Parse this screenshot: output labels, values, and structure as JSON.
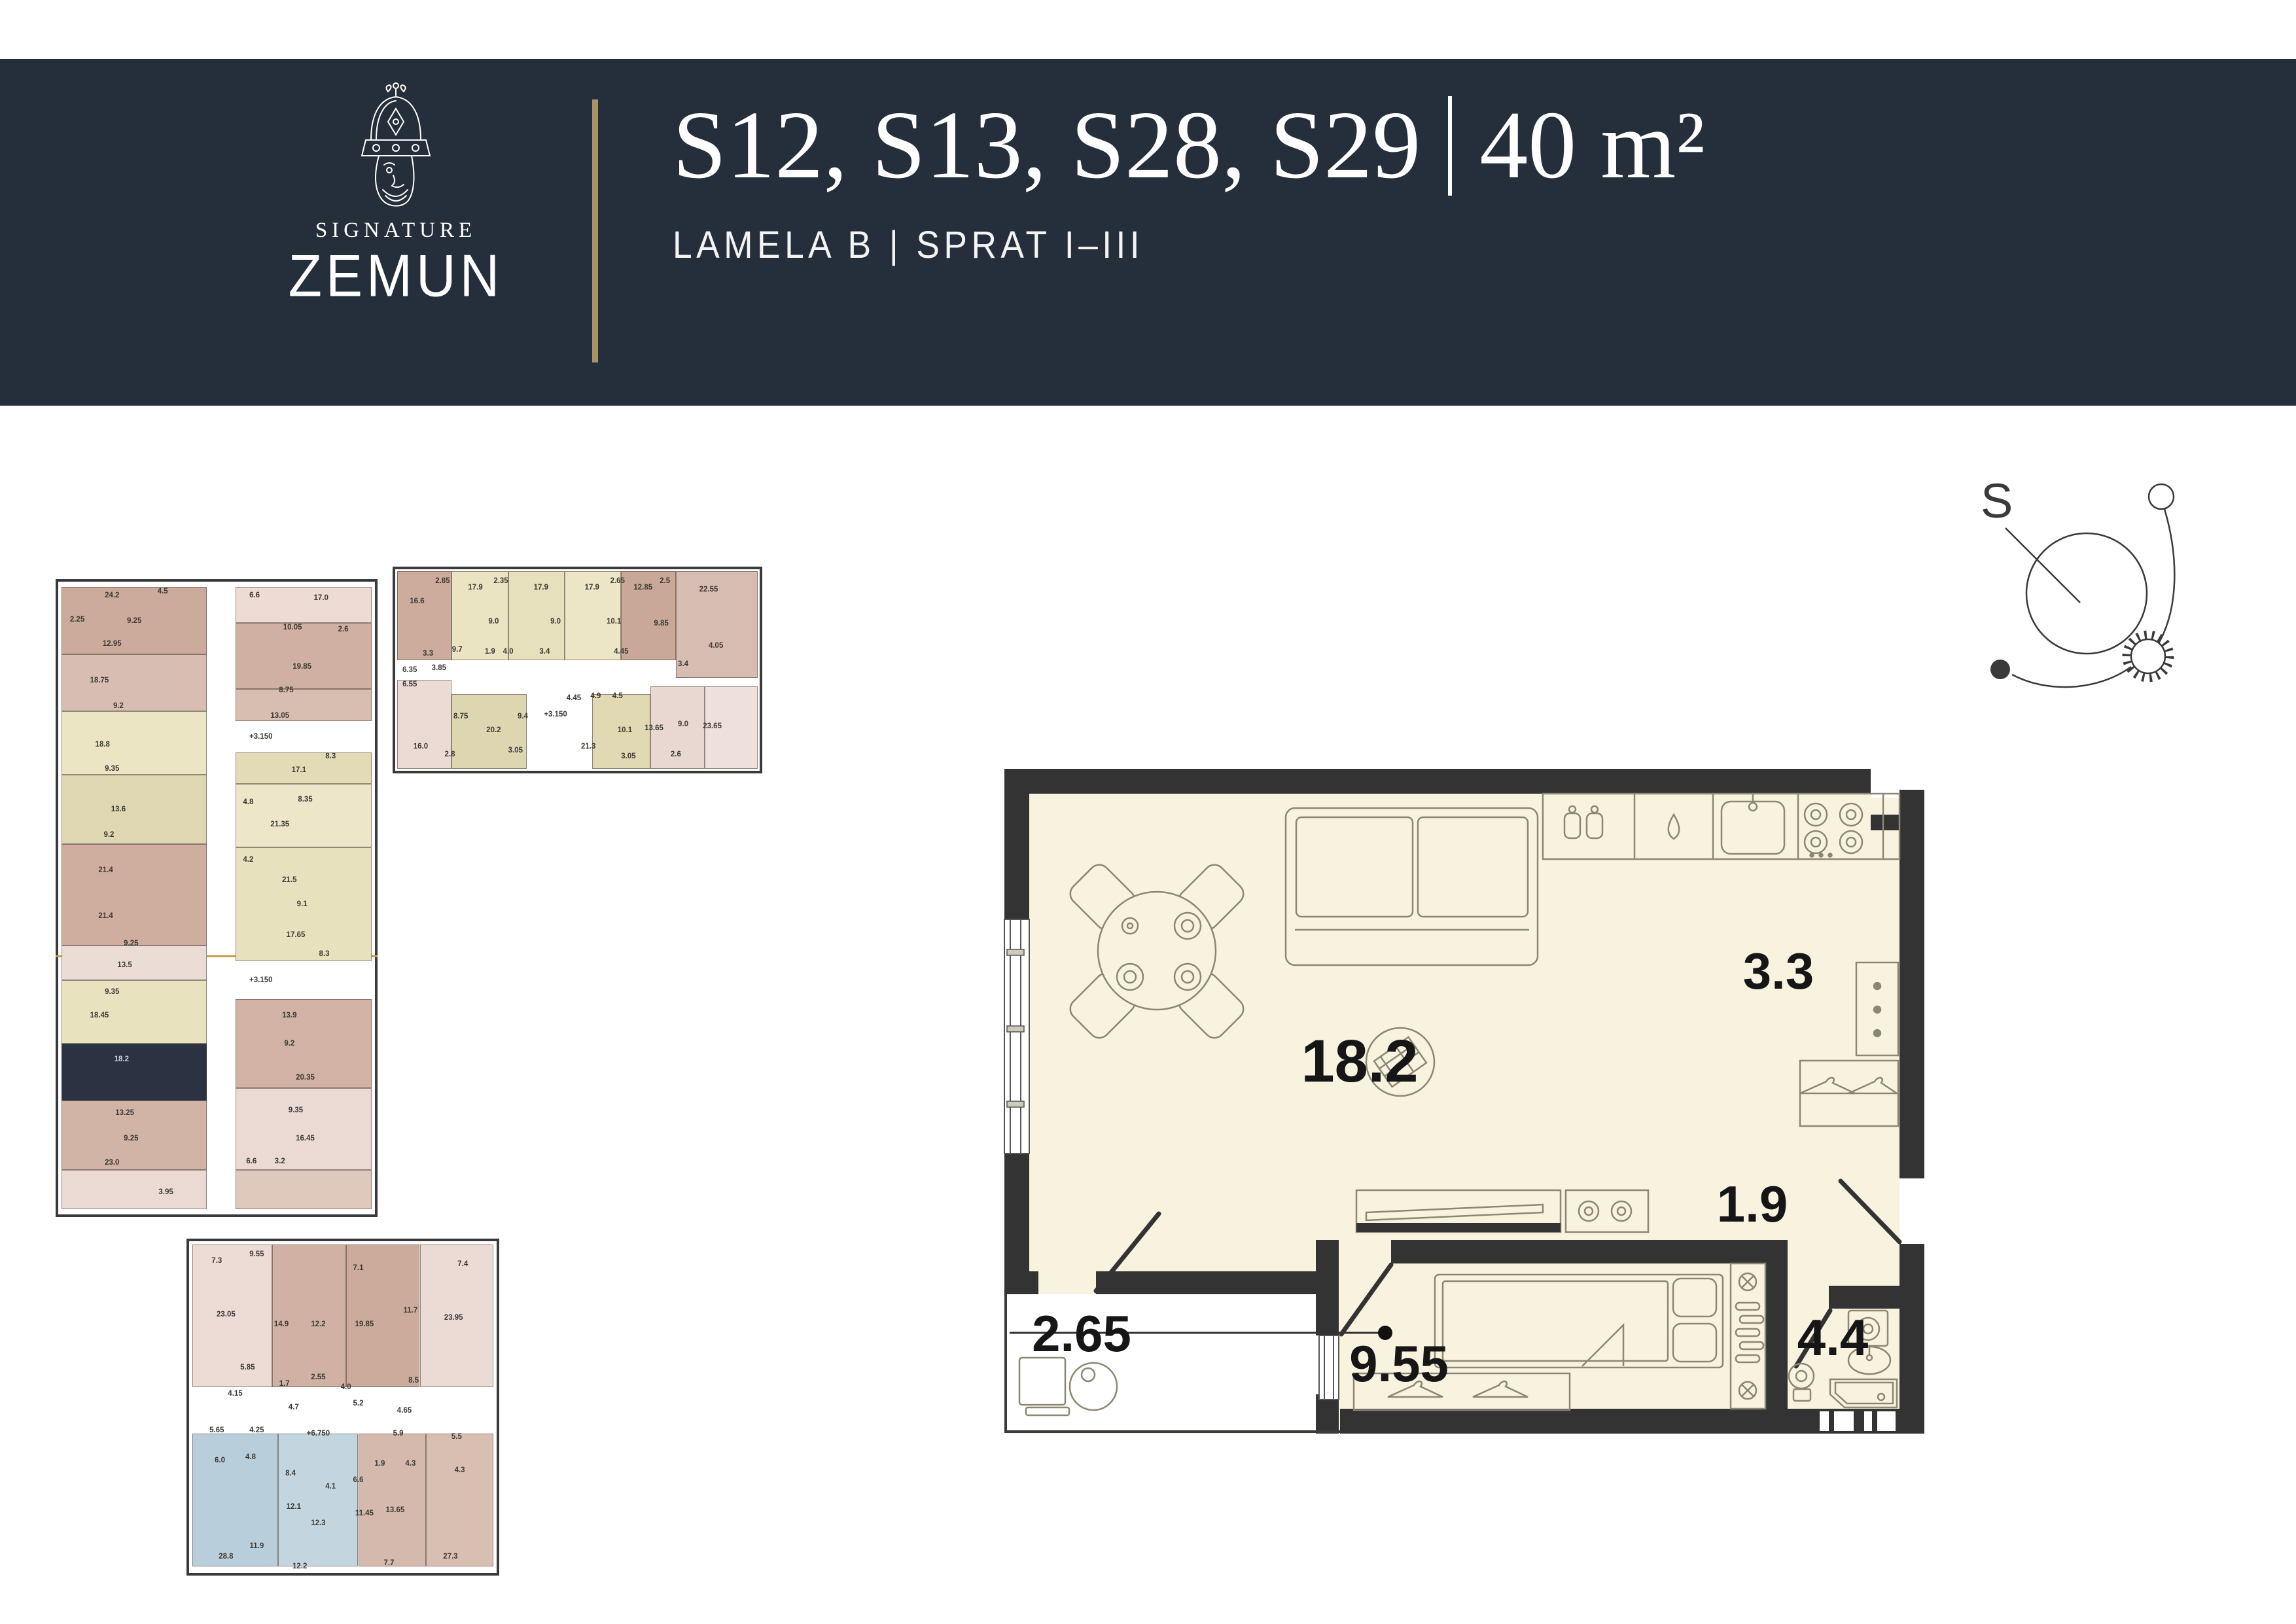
{
  "header": {
    "brand": {
      "name_top": "SIGNATURE",
      "name_bottom": "ZEMUN"
    },
    "title": {
      "units": "S12, S13, S28, S29",
      "area": "40 m²"
    },
    "subtitle": "LAMELA B | SPRAT I–III"
  },
  "compass": {
    "label": "S"
  },
  "colors": {
    "header_bg": "#252e3b",
    "gold": "#ab9265",
    "plan_fill": "#f7f3de",
    "wall": "#333333",
    "furniture_line": "#8b8775",
    "highlight_unit": "#2b3342"
  },
  "main_plan": {
    "rooms": {
      "living": "18.2",
      "kitchen": "3.3",
      "hall": "1.9",
      "balcony": "2.65",
      "bedroom": "9.55",
      "bathroom": "4.4"
    }
  },
  "mini_plans": {
    "tall": {
      "units": [
        [
          1,
          0.8,
          46,
          10.7,
          "#cdab9c"
        ],
        [
          1,
          11.5,
          46,
          9,
          "#d8beb2"
        ],
        [
          1,
          20.5,
          46,
          10,
          "#ece5c4"
        ],
        [
          1,
          30.5,
          46,
          11,
          "#ded7b2"
        ],
        [
          1,
          41.5,
          46,
          16,
          "#cfae9f"
        ],
        [
          1,
          57.5,
          46,
          5.5,
          "#ecdcd6"
        ],
        [
          1,
          63,
          46,
          10,
          "#e9e2bf"
        ],
        [
          1,
          73,
          46,
          9,
          "#2b3342"
        ],
        [
          1,
          82,
          46,
          11,
          "#d2b4a6"
        ],
        [
          1,
          93,
          46,
          6.2,
          "#eadad3"
        ],
        [
          56,
          0.8,
          43,
          5.7,
          "#eddbd4"
        ],
        [
          56,
          6.5,
          43,
          10.5,
          "#cfb0a2"
        ],
        [
          56,
          17,
          43,
          5,
          "#d8beb1"
        ],
        [
          56,
          27,
          43,
          5,
          "#e2dbb6"
        ],
        [
          56,
          32,
          43,
          10,
          "#ede6c8"
        ],
        [
          56,
          42,
          43,
          18,
          "#e8e1bd"
        ],
        [
          56,
          66,
          43,
          14,
          "#d1b2a4"
        ],
        [
          56,
          80,
          43,
          13,
          "#ebdad3"
        ],
        [
          56,
          93,
          43,
          6.2,
          "#dfc9bd"
        ]
      ],
      "labels": [
        {
          "t": "24.2",
          "x": 17,
          "y": 2.2
        },
        {
          "t": "4.5",
          "x": 33,
          "y": 1.5
        },
        {
          "t": "9.25",
          "x": 24,
          "y": 6.2
        },
        {
          "t": "2.25",
          "x": 6,
          "y": 6
        },
        {
          "t": "12.95",
          "x": 17,
          "y": 9.8
        },
        {
          "t": "17.0",
          "x": 83,
          "y": 2.6
        },
        {
          "t": "6.6",
          "x": 62,
          "y": 2.2
        },
        {
          "t": "10.05",
          "x": 74,
          "y": 7.2
        },
        {
          "t": "2.6",
          "x": 90,
          "y": 7.6
        },
        {
          "t": "18.75",
          "x": 13,
          "y": 15.6
        },
        {
          "t": "9.2",
          "x": 19,
          "y": 19.6
        },
        {
          "t": "19.85",
          "x": 77,
          "y": 13.4
        },
        {
          "t": "8.75",
          "x": 72,
          "y": 17.2
        },
        {
          "t": "13.05",
          "x": 70,
          "y": 21.2
        },
        {
          "t": "18.8",
          "x": 14,
          "y": 25.8
        },
        {
          "t": "9.35",
          "x": 17,
          "y": 29.6
        },
        {
          "t": "+3.150",
          "x": 64,
          "y": 24.5
        },
        {
          "t": "17.1",
          "x": 76,
          "y": 29.8
        },
        {
          "t": "8.3",
          "x": 86,
          "y": 27.6
        },
        {
          "t": "13.6",
          "x": 19,
          "y": 36
        },
        {
          "t": "9.2",
          "x": 16,
          "y": 40
        },
        {
          "t": "21.4",
          "x": 15,
          "y": 45.6
        },
        {
          "t": "8.35",
          "x": 78,
          "y": 34.4
        },
        {
          "t": "21.35",
          "x": 70,
          "y": 38.4
        },
        {
          "t": "4.8",
          "x": 60,
          "y": 34.8
        },
        {
          "t": "21.4",
          "x": 15,
          "y": 52.8
        },
        {
          "t": "9.25",
          "x": 23,
          "y": 57.2
        },
        {
          "t": "4.2",
          "x": 60,
          "y": 44
        },
        {
          "t": "21.5",
          "x": 73,
          "y": 47.2
        },
        {
          "t": "9.1",
          "x": 77,
          "y": 51
        },
        {
          "t": "13.5",
          "x": 21,
          "y": 60.6
        },
        {
          "t": "9.35",
          "x": 17,
          "y": 64.8
        },
        {
          "t": "18.45",
          "x": 13,
          "y": 68.6
        },
        {
          "t": "17.65",
          "x": 75,
          "y": 55.8
        },
        {
          "t": "8.3",
          "x": 84,
          "y": 58.8
        },
        {
          "t": "+3.150",
          "x": 64,
          "y": 63
        },
        {
          "t": "18.2",
          "x": 20,
          "y": 75.5,
          "w": 1
        },
        {
          "t": "13.9",
          "x": 73,
          "y": 68.6
        },
        {
          "t": "9.2",
          "x": 73,
          "y": 73
        },
        {
          "t": "13.25",
          "x": 21,
          "y": 84
        },
        {
          "t": "9.25",
          "x": 23,
          "y": 88
        },
        {
          "t": "23.0",
          "x": 17,
          "y": 91.8
        },
        {
          "t": "20.35",
          "x": 78,
          "y": 78.4
        },
        {
          "t": "9.35",
          "x": 75,
          "y": 83.6
        },
        {
          "t": "16.45",
          "x": 78,
          "y": 88
        },
        {
          "t": "6.6",
          "x": 61,
          "y": 91.6
        },
        {
          "t": "3.2",
          "x": 70,
          "y": 91.6
        },
        {
          "t": "3.95",
          "x": 34,
          "y": 96.5
        }
      ]
    },
    "wide": {
      "units": [
        [
          0.5,
          1,
          15,
          44,
          "#cdab9d"
        ],
        [
          15.5,
          1,
          15.5,
          44,
          "#ebe4c3"
        ],
        [
          31,
          1,
          15.5,
          44,
          "#e7e0bc"
        ],
        [
          46.5,
          1,
          15.5,
          44,
          "#ece5c6"
        ],
        [
          62,
          1,
          15,
          44,
          "#c9a898"
        ],
        [
          77,
          1,
          22.5,
          53,
          "#d7bdb1"
        ],
        [
          0.5,
          55,
          15,
          44,
          "#ecdbd5"
        ],
        [
          15.5,
          62,
          20.5,
          37,
          "#ddd6b0"
        ],
        [
          54,
          62,
          16,
          37,
          "#e0d9b3"
        ],
        [
          70,
          58,
          15,
          41,
          "#e9d8d1"
        ],
        [
          85,
          58,
          14.5,
          41,
          "#eee0da"
        ]
      ],
      "labels": [
        {
          "t": "16.6",
          "x": 6,
          "y": 16
        },
        {
          "t": "2.85",
          "x": 13,
          "y": 6
        },
        {
          "t": "3.3",
          "x": 9,
          "y": 42
        },
        {
          "t": "9.7",
          "x": 17,
          "y": 40
        },
        {
          "t": "17.9",
          "x": 22,
          "y": 9
        },
        {
          "t": "9.0",
          "x": 27,
          "y": 26
        },
        {
          "t": "1.9",
          "x": 26,
          "y": 41
        },
        {
          "t": "4.0",
          "x": 31,
          "y": 41
        },
        {
          "t": "2.35",
          "x": 29,
          "y": 6
        },
        {
          "t": "17.9",
          "x": 40,
          "y": 9
        },
        {
          "t": "9.0",
          "x": 44,
          "y": 26
        },
        {
          "t": "3.4",
          "x": 41,
          "y": 41
        },
        {
          "t": "17.9",
          "x": 54,
          "y": 9
        },
        {
          "t": "10.1",
          "x": 60,
          "y": 26
        },
        {
          "t": "4.45",
          "x": 62,
          "y": 41
        },
        {
          "t": "2.65",
          "x": 61,
          "y": 6
        },
        {
          "t": "12.85",
          "x": 68,
          "y": 9
        },
        {
          "t": "9.85",
          "x": 73,
          "y": 27
        },
        {
          "t": "2.5",
          "x": 74,
          "y": 6
        },
        {
          "t": "22.55",
          "x": 86,
          "y": 10
        },
        {
          "t": "4.05",
          "x": 88,
          "y": 38
        },
        {
          "t": "3.4",
          "x": 79,
          "y": 47
        },
        {
          "t": "6.35",
          "x": 4,
          "y": 50
        },
        {
          "t": "3.85",
          "x": 12,
          "y": 49
        },
        {
          "t": "6.55",
          "x": 4,
          "y": 57
        },
        {
          "t": "16.0",
          "x": 7,
          "y": 88
        },
        {
          "t": "8.75",
          "x": 18,
          "y": 73
        },
        {
          "t": "2.8",
          "x": 15,
          "y": 92
        },
        {
          "t": "20.2",
          "x": 27,
          "y": 80
        },
        {
          "t": "9.4",
          "x": 35,
          "y": 73
        },
        {
          "t": "3.05",
          "x": 33,
          "y": 90
        },
        {
          "t": "+3.150",
          "x": 44,
          "y": 72
        },
        {
          "t": "4.45",
          "x": 49,
          "y": 64
        },
        {
          "t": "4.9",
          "x": 55,
          "y": 63
        },
        {
          "t": "4.5",
          "x": 61,
          "y": 63
        },
        {
          "t": "21.3",
          "x": 53,
          "y": 88
        },
        {
          "t": "10.1",
          "x": 63,
          "y": 80
        },
        {
          "t": "13.65",
          "x": 71,
          "y": 79
        },
        {
          "t": "9.0",
          "x": 79,
          "y": 77
        },
        {
          "t": "23.65",
          "x": 87,
          "y": 78
        },
        {
          "t": "2.6",
          "x": 77,
          "y": 92
        },
        {
          "t": "3.05",
          "x": 64,
          "y": 93
        }
      ]
    },
    "bottom": {
      "units": [
        [
          1,
          1,
          26,
          43,
          "#eddcd6"
        ],
        [
          27,
          1,
          24,
          43,
          "#d0b1a3"
        ],
        [
          51,
          1,
          24,
          43,
          "#ccab9c"
        ],
        [
          75,
          1,
          24,
          43,
          "#ecdbd5"
        ],
        [
          1,
          58,
          28,
          40,
          "#b9cedb"
        ],
        [
          29,
          58,
          26,
          40,
          "#c3d6e0"
        ],
        [
          55,
          58,
          22,
          40,
          "#d5b9ac"
        ],
        [
          77,
          58,
          22,
          40,
          "#d9bfb2"
        ]
      ],
      "labels": [
        {
          "t": "7.3",
          "x": 9,
          "y": 6
        },
        {
          "t": "9.55",
          "x": 22,
          "y": 4
        },
        {
          "t": "23.05",
          "x": 12,
          "y": 22
        },
        {
          "t": "14.9",
          "x": 30,
          "y": 25
        },
        {
          "t": "12.2",
          "x": 42,
          "y": 25
        },
        {
          "t": "7.1",
          "x": 55,
          "y": 8
        },
        {
          "t": "19.85",
          "x": 57,
          "y": 25
        },
        {
          "t": "11.7",
          "x": 72,
          "y": 21
        },
        {
          "t": "7.4",
          "x": 89,
          "y": 7
        },
        {
          "t": "23.95",
          "x": 86,
          "y": 23
        },
        {
          "t": "5.85",
          "x": 19,
          "y": 38
        },
        {
          "t": "1.7",
          "x": 31,
          "y": 43
        },
        {
          "t": "2.55",
          "x": 42,
          "y": 41
        },
        {
          "t": "4.0",
          "x": 51,
          "y": 44
        },
        {
          "t": "8.5",
          "x": 73,
          "y": 42
        },
        {
          "t": "4.15",
          "x": 15,
          "y": 46
        },
        {
          "t": "4.7",
          "x": 34,
          "y": 50
        },
        {
          "t": "5.2",
          "x": 55,
          "y": 49
        },
        {
          "t": "4.65",
          "x": 70,
          "y": 51
        },
        {
          "t": "5.65",
          "x": 9,
          "y": 57
        },
        {
          "t": "4.25",
          "x": 22,
          "y": 57
        },
        {
          "t": "+6.750",
          "x": 42,
          "y": 58
        },
        {
          "t": "5.9",
          "x": 68,
          "y": 58
        },
        {
          "t": "5.5",
          "x": 87,
          "y": 59
        },
        {
          "t": "6.0",
          "x": 10,
          "y": 66
        },
        {
          "t": "4.8",
          "x": 20,
          "y": 65
        },
        {
          "t": "8.4",
          "x": 33,
          "y": 70
        },
        {
          "t": "1.9",
          "x": 62,
          "y": 67
        },
        {
          "t": "4.3",
          "x": 72,
          "y": 67
        },
        {
          "t": "4.3",
          "x": 88,
          "y": 69
        },
        {
          "t": "4.1",
          "x": 46,
          "y": 74
        },
        {
          "t": "12.1",
          "x": 34,
          "y": 80
        },
        {
          "t": "6.6",
          "x": 55,
          "y": 72
        },
        {
          "t": "11.45",
          "x": 57,
          "y": 82
        },
        {
          "t": "13.65",
          "x": 67,
          "y": 81
        },
        {
          "t": "11.9",
          "x": 22,
          "y": 92
        },
        {
          "t": "28.8",
          "x": 12,
          "y": 95
        },
        {
          "t": "12.3",
          "x": 42,
          "y": 85
        },
        {
          "t": "12.2",
          "x": 36,
          "y": 98
        },
        {
          "t": "7.7",
          "x": 65,
          "y": 97
        },
        {
          "t": "27.3",
          "x": 85,
          "y": 95
        }
      ]
    }
  }
}
